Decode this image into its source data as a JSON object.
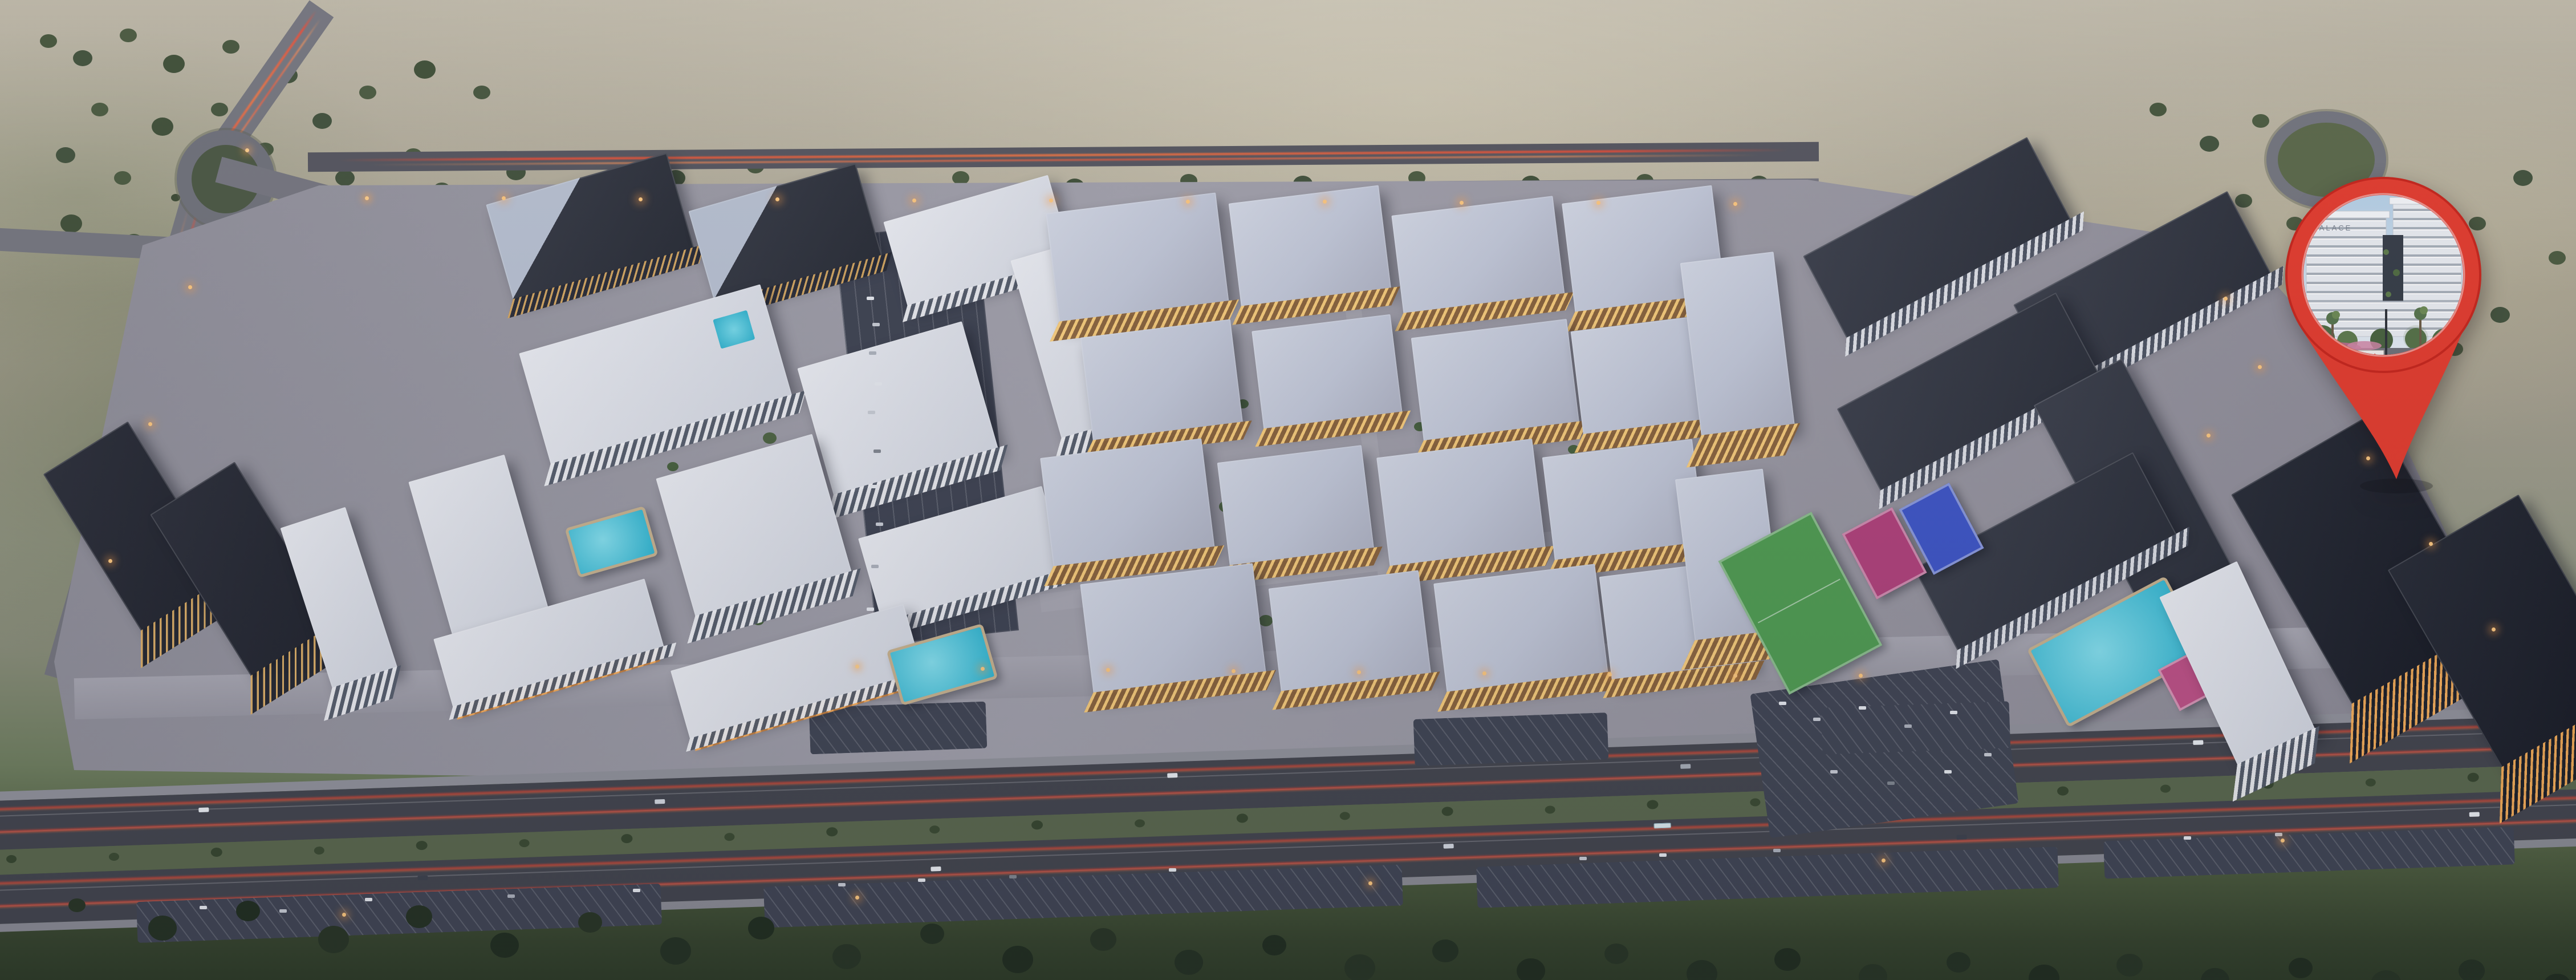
{
  "pin": {
    "signage": "PALACE",
    "icon": "map-pin-icon",
    "logo_icon": "red-diamond-chevrons-logo"
  },
  "icons": {
    "location_pin": "map-pin-icon"
  },
  "colors": {
    "pin_red": "#e63a2b",
    "pin_red_deep": "#c92318",
    "pool_teal": "#2fb7d2",
    "field_green": "#4f9d50",
    "court_blue": "#3d55c8",
    "court_magenta": "#b2407a",
    "lit_window": "#ffd078",
    "roof_dark": "#3a3e49",
    "tan_wall": "#c5935c",
    "asphalt": "#42444c",
    "taillight_red": "#ff4830",
    "desert_sand": "#aaa490",
    "foreground_green": "#2c3a24"
  }
}
